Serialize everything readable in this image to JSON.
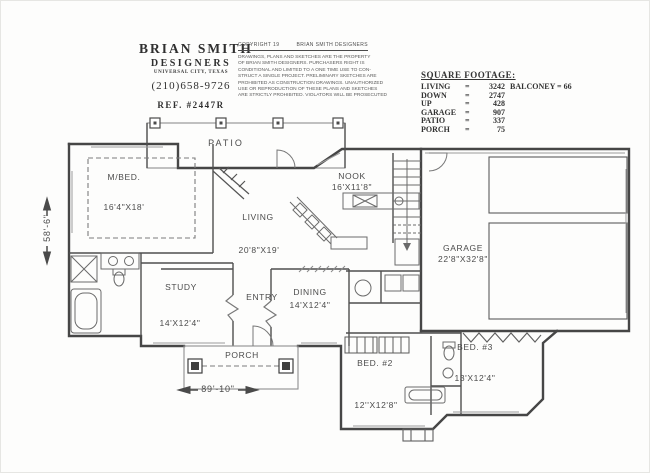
{
  "title_block": {
    "name": "BRIAN SMITH",
    "sub": "DESIGNERS",
    "city": "UNIVERSAL CITY, TEXAS",
    "phone": "(210)658-9726",
    "ref": "REF. #2447R"
  },
  "copyright": {
    "header_left": "COPYRIGHT 19",
    "header_right": "BRIAN SMITH DESIGNERS",
    "lines": [
      "DRAWINGS, PLANS AND SKETCHES ARE THE PROPERTY",
      "OF BRIAN SMITH DESIGNERS.  PURCHASERS RIGHT IS",
      "CONDITIONAL AND LIMITED TO A ONE TIME USE TO CON-",
      "STRUCT A SINGLE PROJECT.  PRELIMINARY SKETCHES ARE",
      "PROHIBITED AS CONSTRUCTION DRAWINGS.  UNAUTHORIZED",
      "USE OR REPRODUCTION OF THESE PLANS AND SKETCHES",
      "ARE STRICTLY PROHIBITED.  VIOLATORS WILL BE PROSECUTED"
    ]
  },
  "square_footage": {
    "title": "SQUARE FOOTAGE:",
    "eq": "=",
    "rows": [
      {
        "label": "LIVING",
        "value": "3242",
        "extra": "BALCONEY = 66"
      },
      {
        "label": "DOWN",
        "value": "2747",
        "extra": ""
      },
      {
        "label": "UP",
        "value": "428",
        "extra": ""
      },
      {
        "label": "GARAGE",
        "value": "907",
        "extra": ""
      },
      {
        "label": "PATIO",
        "value": "337",
        "extra": ""
      },
      {
        "label": "PORCH",
        "value": "75",
        "extra": ""
      }
    ]
  },
  "rooms": {
    "patio": {
      "name": "PATIO"
    },
    "mbed": {
      "name": "M/BED.",
      "dims": "16'4\"X18'"
    },
    "living": {
      "name": "LIVING",
      "dims": "20'8\"X19'"
    },
    "nook": {
      "name": "NOOK",
      "dims": "16'X11'8\""
    },
    "garage": {
      "name": "GARAGE",
      "dims": "22'8\"X32'8\""
    },
    "study": {
      "name": "STUDY",
      "dims": "14'X12'4\""
    },
    "entry": {
      "name": "ENTRY"
    },
    "dining": {
      "name": "DINING",
      "dims": "14'X12'4\""
    },
    "porch": {
      "name": "PORCH"
    },
    "bed2": {
      "name": "BED. #2",
      "dims": "12''X12'8\""
    },
    "bed3": {
      "name": "BED. #3",
      "dims": "13'X12'4\""
    }
  },
  "dimensions": {
    "overall_width": "89'-10\"",
    "overall_height": "58'-6\""
  }
}
